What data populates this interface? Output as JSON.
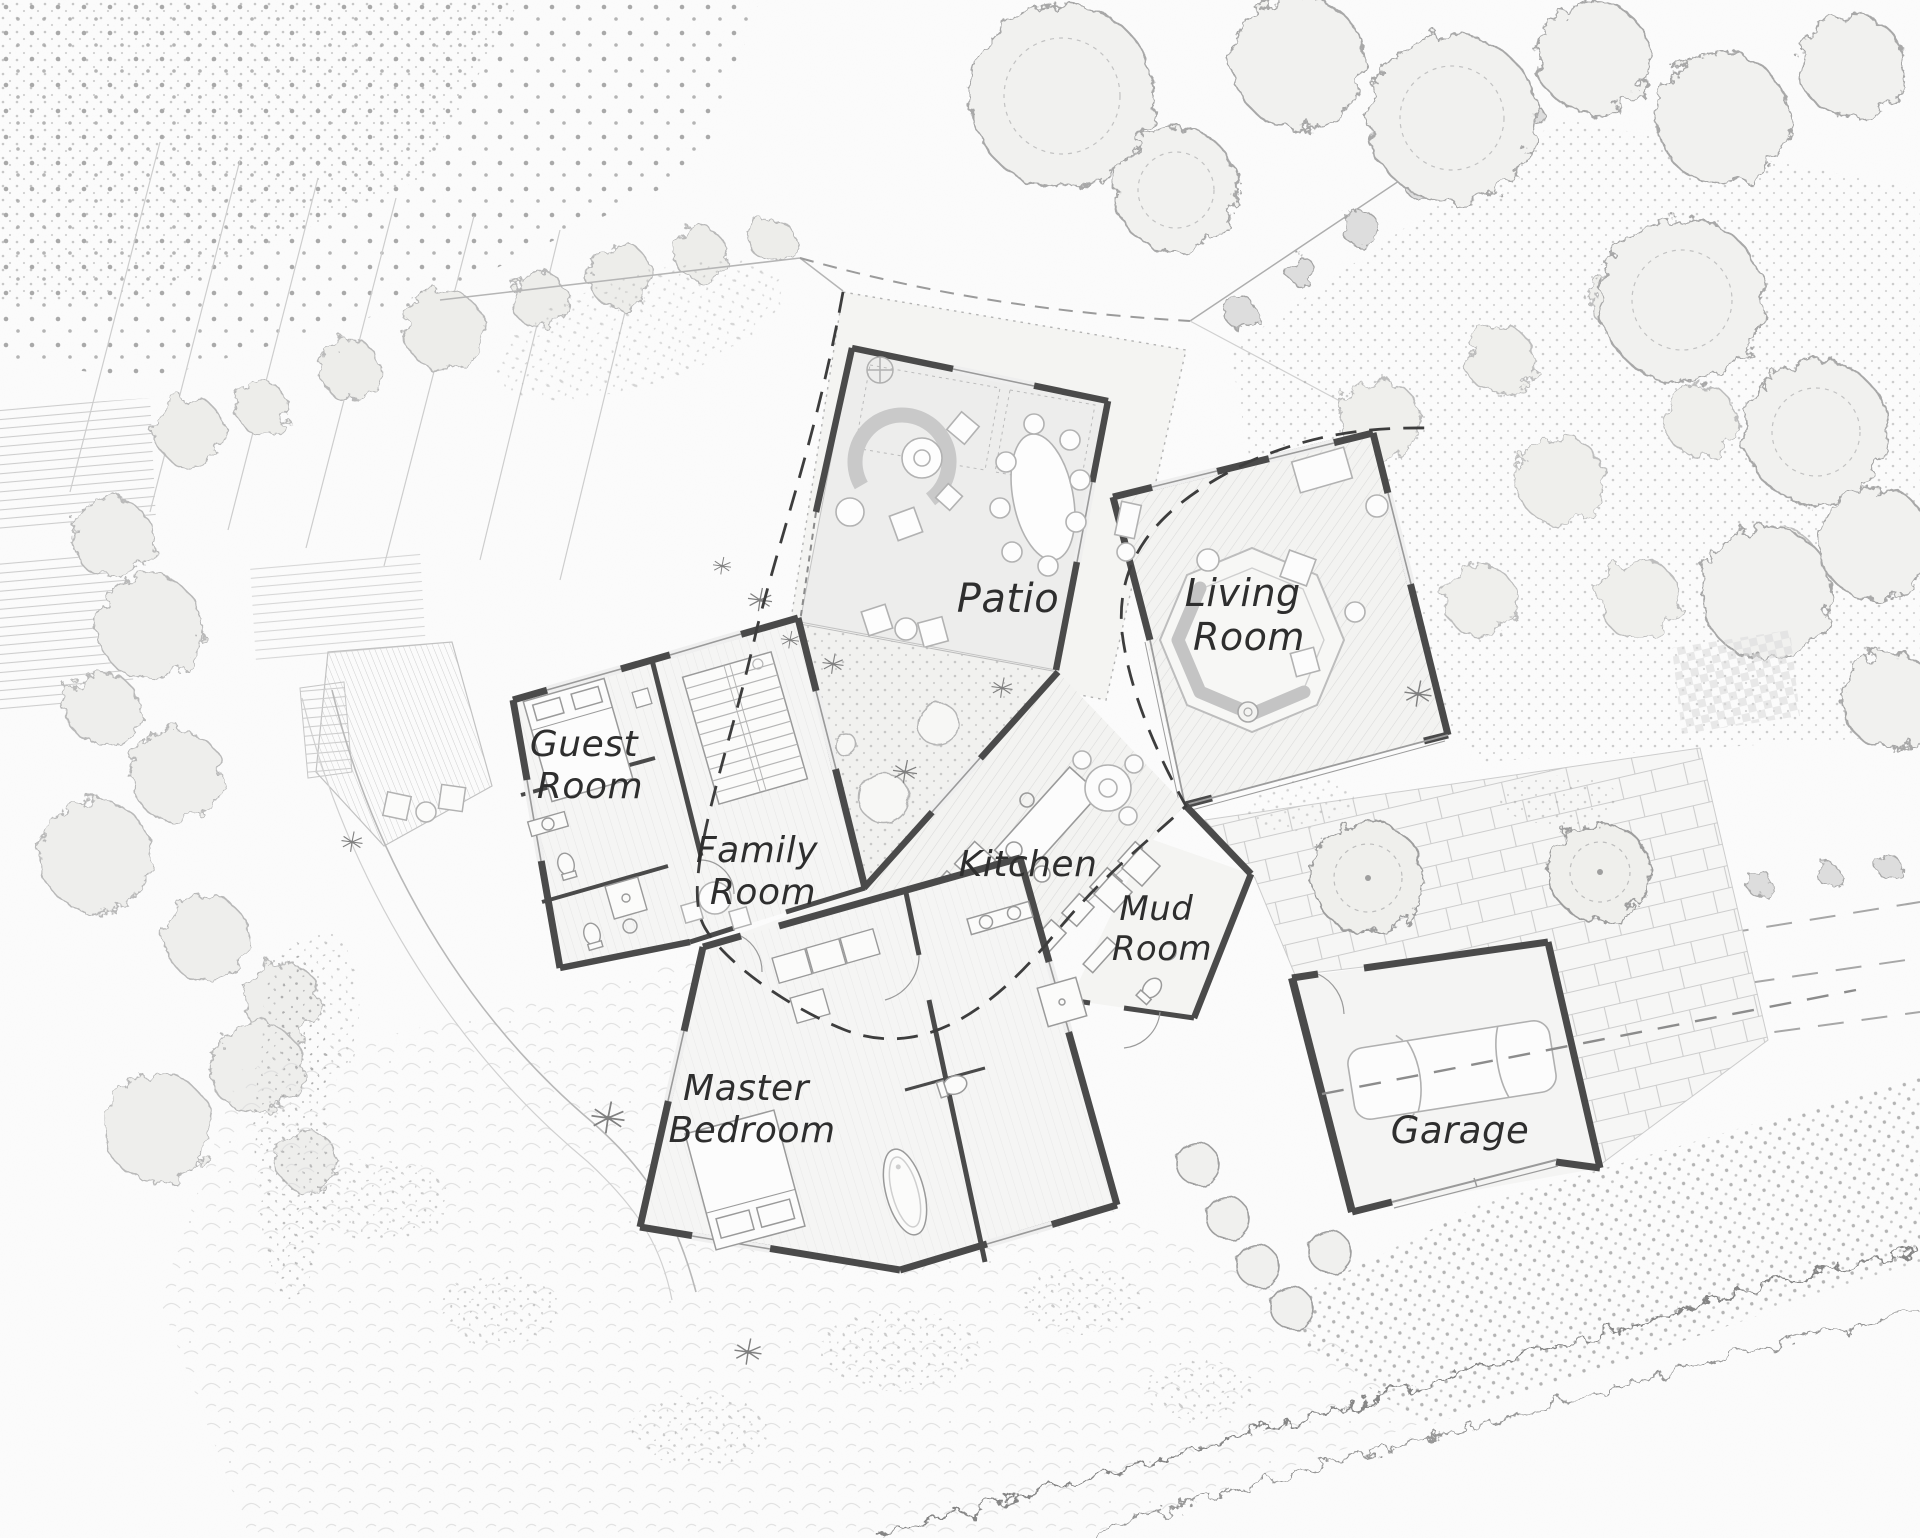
{
  "colors": {
    "paper": "#fcfcfc",
    "ink": "#2e2e2e",
    "wall": "#4a4a4a",
    "thin_line": "#9b9b9b",
    "floor_fill": "#f3f3f1",
    "patio_fill": "#ededec",
    "hatch": "#d3d3d3",
    "vegetation": "#b9b9b9",
    "stipple": "#9a9a9a",
    "shoreline": "#858585",
    "dashed_line": "#3d3d3d"
  },
  "plan": {
    "rooms": [
      {
        "id": "patio",
        "lines": [
          "Patio",
          ""
        ]
      },
      {
        "id": "living-room",
        "lines": [
          "Living",
          "Room"
        ]
      },
      {
        "id": "guest-room",
        "lines": [
          "Guest",
          "Room"
        ]
      },
      {
        "id": "family-room",
        "lines": [
          "Family",
          "Room"
        ]
      },
      {
        "id": "kitchen",
        "lines": [
          "Kitchen",
          ""
        ]
      },
      {
        "id": "mud-room",
        "lines": [
          "Mud",
          "Room"
        ]
      },
      {
        "id": "master-bedroom",
        "lines": [
          "Master",
          "Bedroom"
        ]
      },
      {
        "id": "garage",
        "lines": [
          "Garage",
          ""
        ]
      }
    ],
    "features": {
      "outdoor": [
        "patio-terrace",
        "courtyard-garden",
        "paver-courtyard",
        "west-deck",
        "lawn",
        "orchard-rows",
        "tree-canopies",
        "hedges",
        "shrub-row",
        "fern-meadow",
        "shoreline",
        "beach",
        "road-dashes",
        "site-boundary"
      ],
      "furniture": [
        "curved-sofa",
        "coffee-table",
        "dining-table",
        "sunken-lounge",
        "fire-pit",
        "kitchen-island",
        "round-table",
        "stairs",
        "beds",
        "bathtub",
        "toilets",
        "vanities",
        "washer-dryer",
        "car"
      ]
    }
  }
}
